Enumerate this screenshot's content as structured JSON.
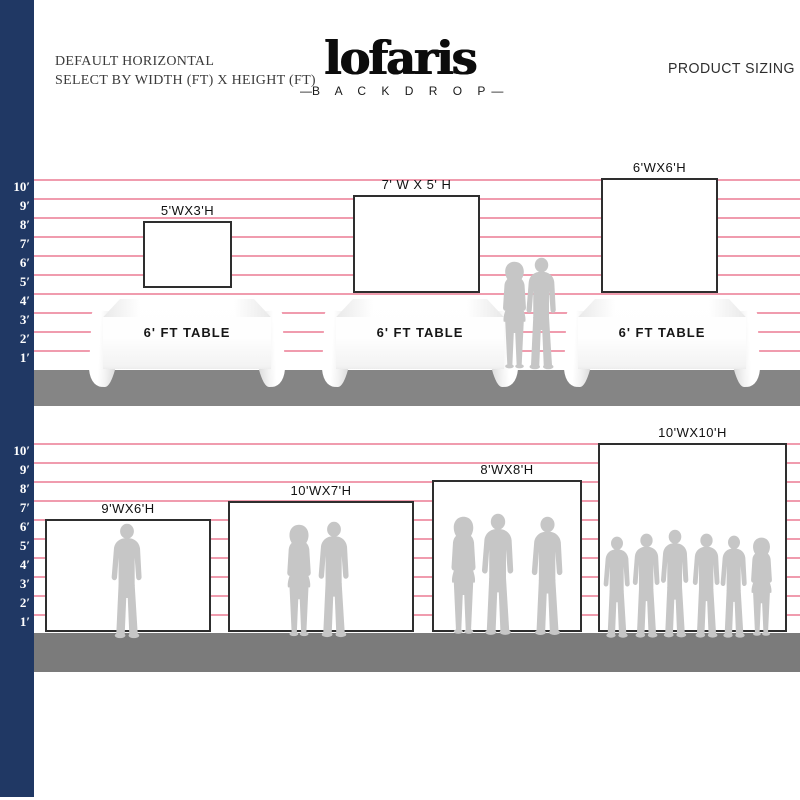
{
  "header": {
    "note_line1": "DEFAULT HORIZONTAL",
    "note_line2": "SELECT BY WIDTH (FT) X HEIGHT (FT)",
    "logo_text": "lofaris",
    "logo_dash": "—",
    "logo_subtext": "B A C K D R O P",
    "product_sizing_label": "PRODUCT SIZING"
  },
  "ruler": {
    "labels": [
      "10′",
      "9′",
      "8′",
      "7′",
      "6′",
      "5′",
      "4′",
      "3′",
      "2′",
      "1′"
    ]
  },
  "top_row": {
    "table_label": "6' FT TABLE",
    "backdrops": [
      {
        "label": "5'WX3'H",
        "width_ft": 5,
        "height_ft": 3
      },
      {
        "label": "7' W X 5' H",
        "width_ft": 7,
        "height_ft": 5
      },
      {
        "label": "6'WX6'H",
        "width_ft": 6,
        "height_ft": 6
      }
    ]
  },
  "bottom_row": {
    "backdrops": [
      {
        "label": "9'WX6'H",
        "width_ft": 9,
        "height_ft": 6
      },
      {
        "label": "10'WX7'H",
        "width_ft": 10,
        "height_ft": 7
      },
      {
        "label": "8'WX8'H",
        "width_ft": 8,
        "height_ft": 8
      },
      {
        "label": "10'WX10'H",
        "width_ft": 10,
        "height_ft": 10
      }
    ]
  },
  "colors": {
    "navy": "#203864",
    "pink": "#f09cae",
    "floor1": "#858585",
    "floor2": "#7b7b7b",
    "sil": "#c6c6c6"
  }
}
